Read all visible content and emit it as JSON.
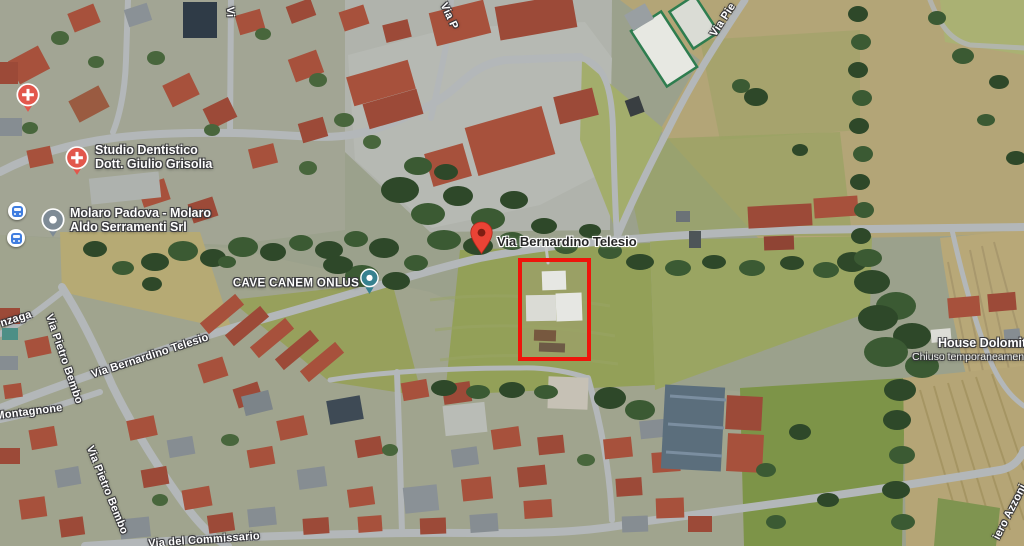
{
  "map": {
    "marker_address": "Via Bernardino Telesio",
    "marker_color": "#EA4335",
    "selection_rectangle_color": "#EE150B",
    "pois": {
      "studio_dentistico": {
        "line1": "Studio Dentistico",
        "line2": "Dott. Giulio Grisolia",
        "icon": "health-poi-icon",
        "icon_color": "#E2574C"
      },
      "molaro": {
        "line1": "Molaro Padova - Molaro",
        "line2": "Aldo Serramenti Srl",
        "icon": "business-poi-icon",
        "icon_color": "#7E8B96"
      },
      "cave_canem": {
        "name": "CAVE CANEM ONLUS",
        "icon": "place-pin-icon",
        "icon_color": "#37818F"
      },
      "house_dolomiti": {
        "name": "House Dolomiti",
        "status": "Chiuso temporaneamente"
      },
      "health_unnamed": {
        "icon": "health-poi-icon",
        "icon_color": "#E2574C"
      }
    },
    "transit": {
      "bus_stop_color": "#3F7DE0"
    },
    "streets": {
      "telesio_diag": "Via Bernardino Telesio",
      "bembo_1": "Via Pietro Bembo",
      "bembo_2": "Via Pietro Bembo",
      "nzaga": "nzaga",
      "montagnone": "Montagnone",
      "commissario": "Via del Commissario",
      "via_p": "Via P",
      "vi": "Vi",
      "via_pie": "Via Pie",
      "azzoni": "iero Azzoni"
    }
  }
}
